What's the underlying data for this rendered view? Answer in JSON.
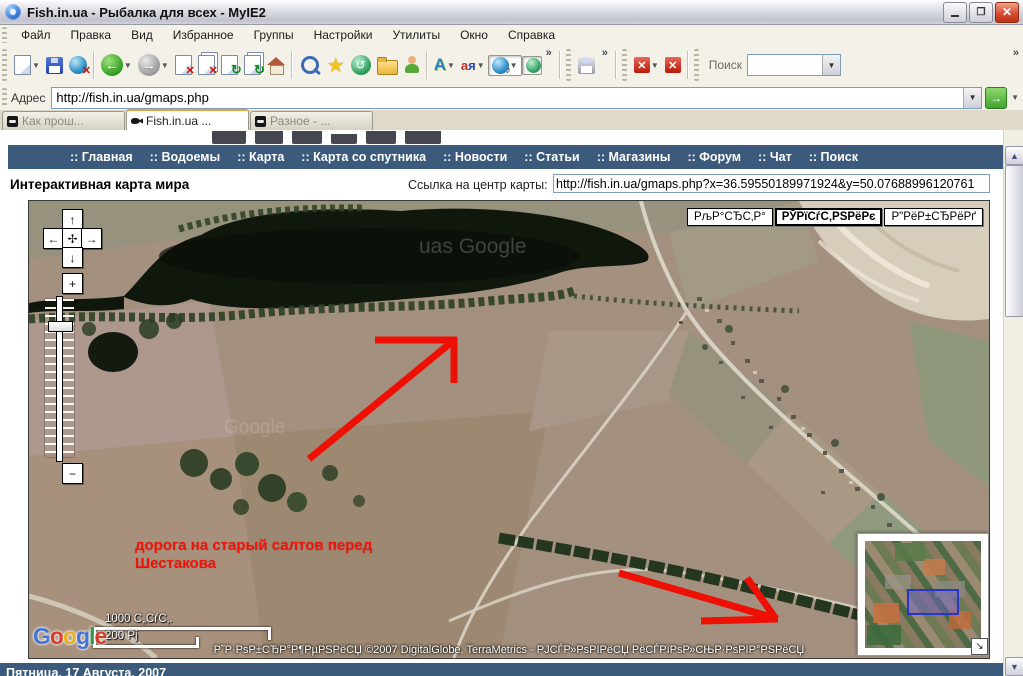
{
  "window": {
    "title": "Fish.in.ua - Рыбалка для всех - MyIE2"
  },
  "menu": {
    "items": [
      "Файл",
      "Правка",
      "Вид",
      "Избранное",
      "Группы",
      "Настройки",
      "Утилиты",
      "Окно",
      "Справка"
    ]
  },
  "toolbar": {
    "search_label": "Поиск",
    "search_value": "",
    "more_label": "»"
  },
  "address_bar": {
    "label": "Адрес",
    "value": "http://fish.in.ua/gmaps.php"
  },
  "tabs": [
    {
      "label": "Как прош..."
    },
    {
      "label": "Fish.in.ua ..."
    },
    {
      "label": "Разное - ..."
    }
  ],
  "site_nav": {
    "items": [
      ":: Главная",
      ":: Водоемы",
      ":: Карта",
      ":: Карта со спутника",
      ":: Новости",
      ":: Статьи",
      ":: Магазины",
      ":: Форум",
      ":: Чат",
      ":: Поиск"
    ]
  },
  "page": {
    "heading": "Интерактивная карта мира",
    "center_link_label": "Ссылка на центр карты:",
    "center_link_value": "http://fish.in.ua/gmaps.php?x=36.59550189971924&y=50.07688996120761"
  },
  "map": {
    "type_buttons": [
      {
        "label": "РљР°СЂС‚Р°"
      },
      {
        "label": "РЎРїСѓС‚РЅРёРє"
      },
      {
        "label": "Р\"РёР±СЂРёРґ"
      }
    ],
    "annotation_line1": "дорога на старый салтов  перед",
    "annotation_line2": "Шестакова",
    "scale_top": "1000 С„СѓС‚.",
    "scale_bottom": "200 Рј",
    "attribution": "Р˜Р·РѕР±СЂР°Р¶РµРЅРёСЏ ©2007 DigitalGlobe, TerraMetrics - РЈСЃР»РѕРІРёСЏ РёСЃРїРѕР»СЊР·РѕРІР°РЅРёСЏ",
    "watermark1": "uas Google",
    "watermark2": "Google",
    "logo_letters": [
      {
        "ch": "G"
      },
      {
        "ch": "o"
      },
      {
        "ch": "o"
      },
      {
        "ch": "g"
      },
      {
        "ch": "l"
      },
      {
        "ch": "e"
      }
    ]
  },
  "footer": {
    "date": "Пятница, 17 Августа, 2007"
  },
  "colors": {
    "nav_bar": "#3c5a7c",
    "annotation_red": "#f2130a",
    "arrow_red": "#ee1005",
    "active_tab_accent": "#e8a33d",
    "water_dark": "#10170d",
    "field_brown": "#a4907e"
  }
}
